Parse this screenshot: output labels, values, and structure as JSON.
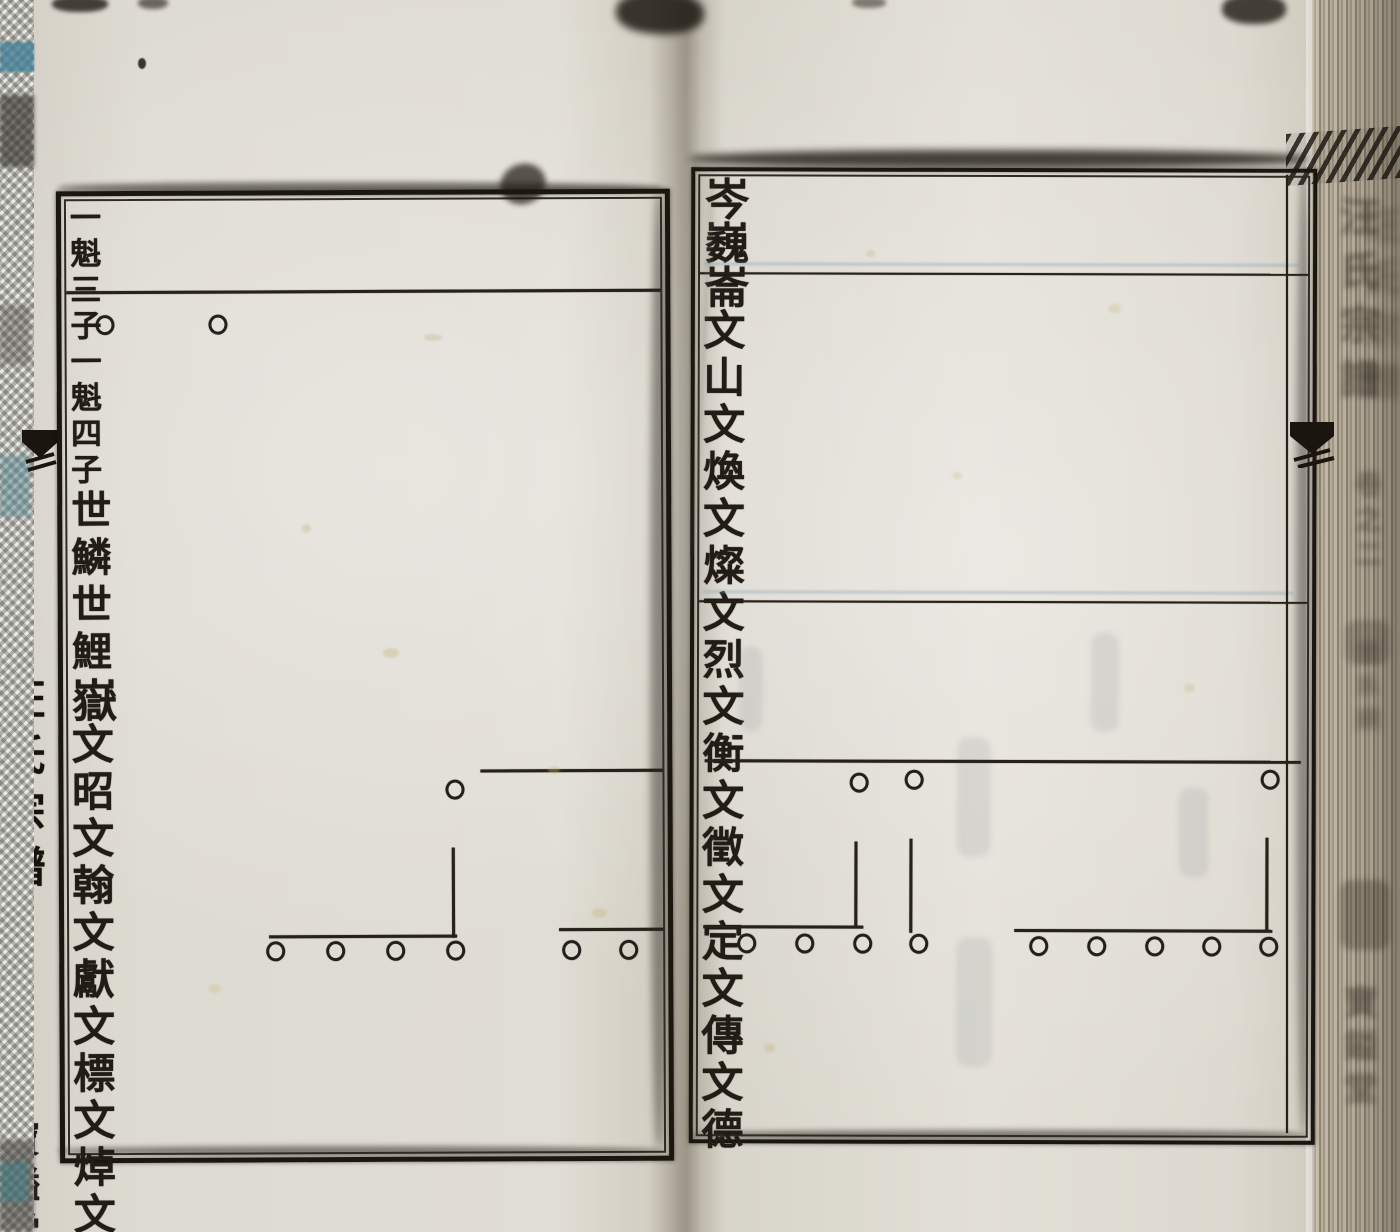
{
  "left_spine": {
    "title": "汪氏宗譜",
    "volume": "卷之二",
    "section": "圩股綱",
    "page_number": "十六",
    "hall_mark": "寶鎰堂"
  },
  "right_spine": {
    "title": "汪氏宗譜",
    "volume": "卷之二",
    "section": "世系綱",
    "hall_mark": "寶鎰堂"
  },
  "left_page": {
    "header": {
      "entries": [
        {
          "father": "一魁",
          "son_rank": "三子"
        },
        {
          "father": "一魁",
          "son_rank": "四子"
        }
      ]
    },
    "generation_row": [
      "世鱗",
      "世鯉"
    ],
    "tree": {
      "ancestor": "嶽",
      "descendants": [
        "文昭",
        "文翰",
        "文獻",
        "文標"
      ],
      "continued_descendants": [
        "文焯",
        "文炳"
      ]
    }
  },
  "right_page": {
    "trees": [
      {
        "ancestor": "岑",
        "descendants": [
          "文山"
        ]
      },
      {
        "ancestor": "巍",
        "descendants": [
          "文煥",
          "文燦",
          "文烈"
        ]
      },
      {
        "ancestor": "崙",
        "descendants": [
          "文衡",
          "文徵",
          "文定",
          "文傳",
          "文德"
        ]
      }
    ]
  }
}
